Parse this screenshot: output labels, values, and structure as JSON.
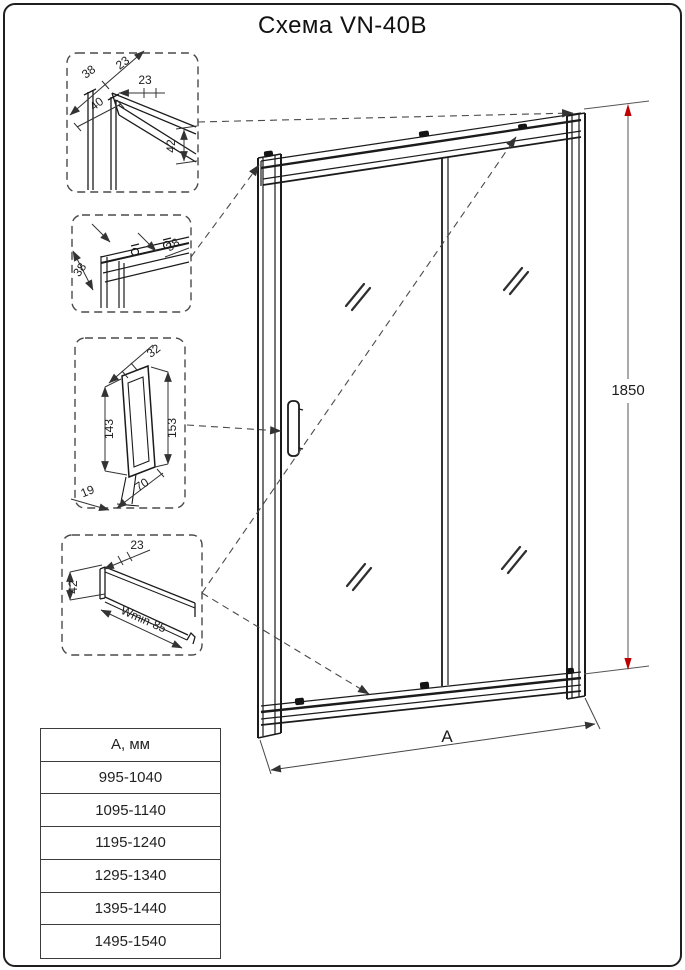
{
  "title": "Схема VN-40B",
  "main": {
    "height_label": "1850",
    "width_label": "А"
  },
  "detail_top_corner": {
    "d38": "38",
    "d23a": "23",
    "d23b": "23",
    "d40": "40",
    "d42": "42"
  },
  "detail_top_rail": {
    "d38a": "38",
    "d38b": "38"
  },
  "detail_handle": {
    "d32": "32",
    "d143": "143",
    "d153": "153",
    "d19": "19",
    "d70": "70"
  },
  "detail_bottom_rail": {
    "d23": "23",
    "d42": "42",
    "dwmin": "Wmin-85"
  },
  "size_table": {
    "header": "А, мм",
    "rows": [
      "995-1040",
      "1095-1140",
      "1195-1240",
      "1295-1340",
      "1395-1440",
      "1495-1540"
    ]
  },
  "colors": {
    "accent_red": "#c00000",
    "line": "#1b1b1b"
  }
}
